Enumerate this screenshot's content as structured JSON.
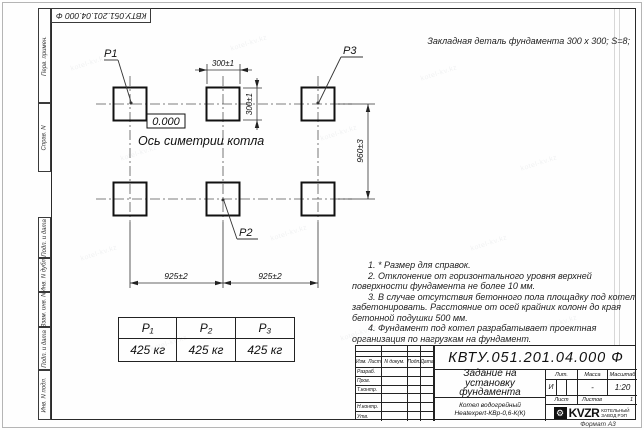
{
  "watermark": {
    "text": "kotel-kv.kz"
  },
  "doc": {
    "number_rotated": "КВТУ.051.201.04.000 Ф",
    "format_label": "Формат А3"
  },
  "frame": {
    "left_labels": [
      "Перв. примен.",
      "Справ. N",
      "Подп. и дата",
      "Инв. N дубл.",
      "Взам. инв. N",
      "Подп. и дата",
      "Инв. N подл."
    ]
  },
  "drawing": {
    "header_note": "Закладная деталь фундамента  300 x 300;  S=8;",
    "zero_mark": "0.000",
    "axis_label": "Ось симетрии котла",
    "labels": {
      "p1": "Р1",
      "p2": "Р2",
      "p3": "Р3"
    },
    "dims": {
      "pad_width": "300±1",
      "pad_height": "300±1",
      "span_left": "925±2",
      "span_right": "925±2",
      "row_spacing": "960±3"
    }
  },
  "notes": [
    "1. * Размер для справок.",
    "2. Отклонение от горизонтального уровня верхней поверхности фундамента не более 10 мм.",
    "3. В случае отсутствия бетонного пола площадку под котел забетонировать. Расстояние от осей крайних колонн до края бетонной подушки 500 мм.",
    "4. Фундамент под котел разрабатывает проектная организация по нагрузкам на фундамент."
  ],
  "load_table": {
    "headers": [
      "Р₁",
      "Р₂",
      "Р₃"
    ],
    "values": [
      "425 кг",
      "425 кг",
      "425 кг"
    ]
  },
  "title_block": {
    "doc_number": "КВТУ.051.201.04.000  Ф",
    "title": "Задание на установку фундамента",
    "product_line1": "Котел водогрейный",
    "product_line2": "Heatexpert-КВр-0,6-К(К)",
    "col_izm_list": "Изм. Лист",
    "col_ndok": "N докум.",
    "col_podp": "Подп.",
    "col_data": "Дата",
    "row_razrab": "Разраб.",
    "row_prov": "Пров.",
    "row_tkontr": "Т.контр.",
    "row_nkontr": "Н.контр.",
    "row_utv": "Утв.",
    "lit_header": "Лит.",
    "mass_header": "Масса",
    "scale_header": "Масштаб",
    "lit_value": "И",
    "mass_value": "-",
    "scale_value": "1:20",
    "sheet_label": "Лист",
    "sheets_label": "Листов",
    "sheets_value": "1",
    "logo_text": "KVZR",
    "logo_sub1": "КОТЕЛЬНЫЙ",
    "logo_sub2": "ЗАВОД РЭП"
  },
  "icons": {
    "kvzr_logo": "⚙"
  }
}
